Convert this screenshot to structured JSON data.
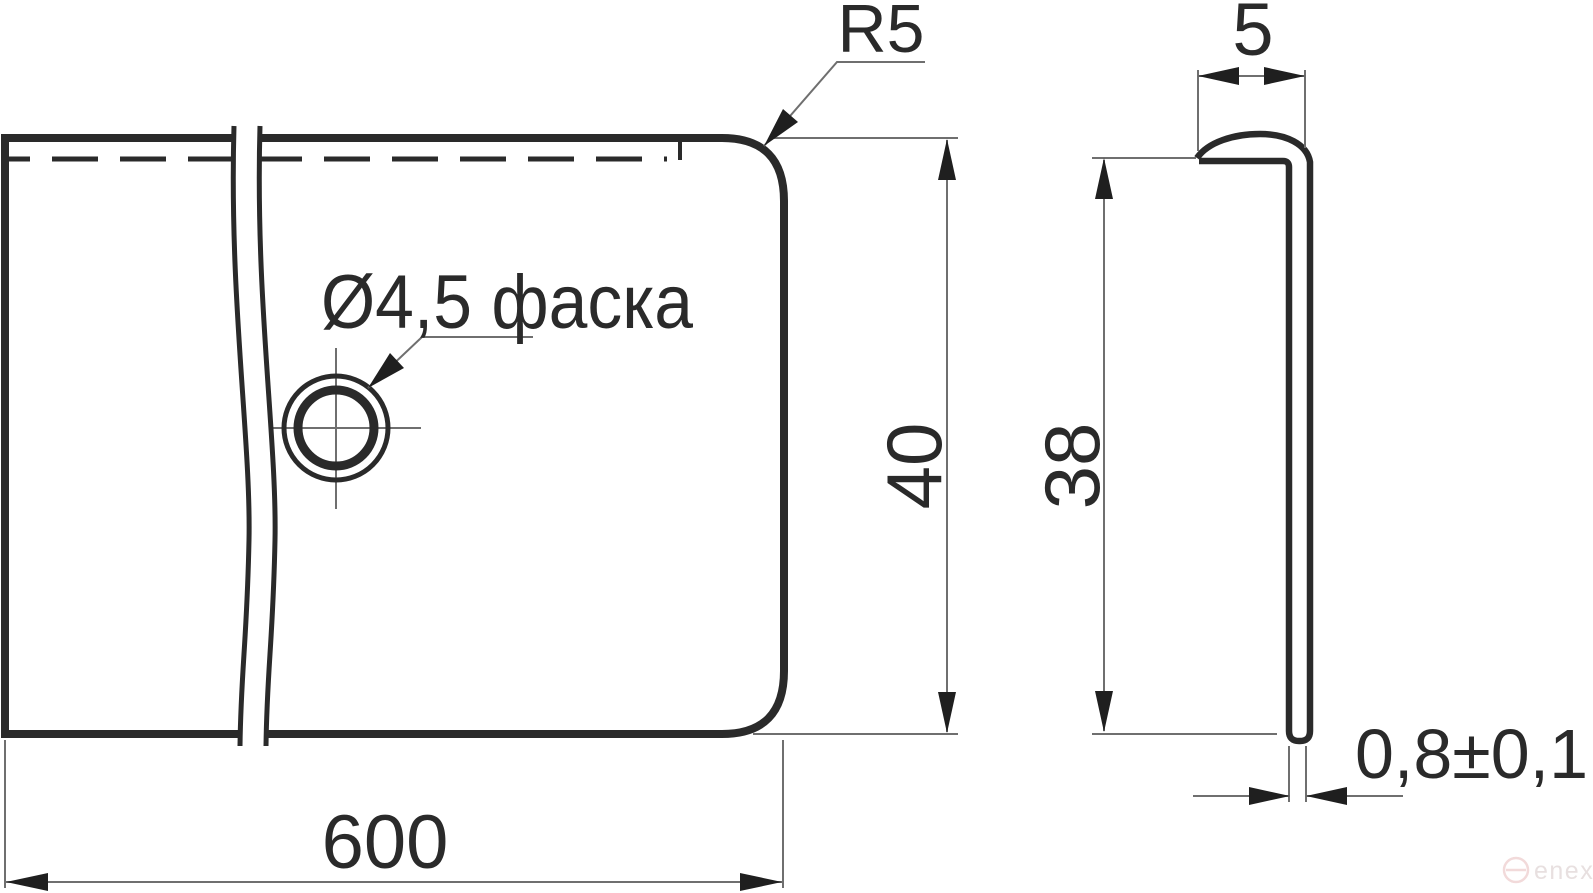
{
  "drawing_type": "technical-drawing",
  "views": {
    "front_view": "end-strip front view with break lines",
    "side_view": "L-profile cross-section side view"
  },
  "dimensions": {
    "length": {
      "label": "600",
      "value": 600
    },
    "front_height": {
      "label": "40",
      "value": 40
    },
    "corner_radius": {
      "label": "R5",
      "value": 5
    },
    "hole": {
      "label": "Ø4,5 фаска",
      "diameter": 4.5,
      "note": "фаска"
    },
    "flange_width": {
      "label": "5",
      "value": 5
    },
    "side_height": {
      "label": "38",
      "value": 38
    },
    "thickness": {
      "label": "0,8±0,1",
      "value": 0.8,
      "tolerance": 0.1
    }
  },
  "watermark": {
    "text": "enex"
  },
  "colors": {
    "background": "#ffffff",
    "outline": "#2a2a2a",
    "thin_line": "#6f6f6f",
    "arrow": "#1f1f1f",
    "text": "#2a2a2a",
    "watermark_logo": "#f2dada",
    "watermark_text": "#e8e0e0"
  }
}
